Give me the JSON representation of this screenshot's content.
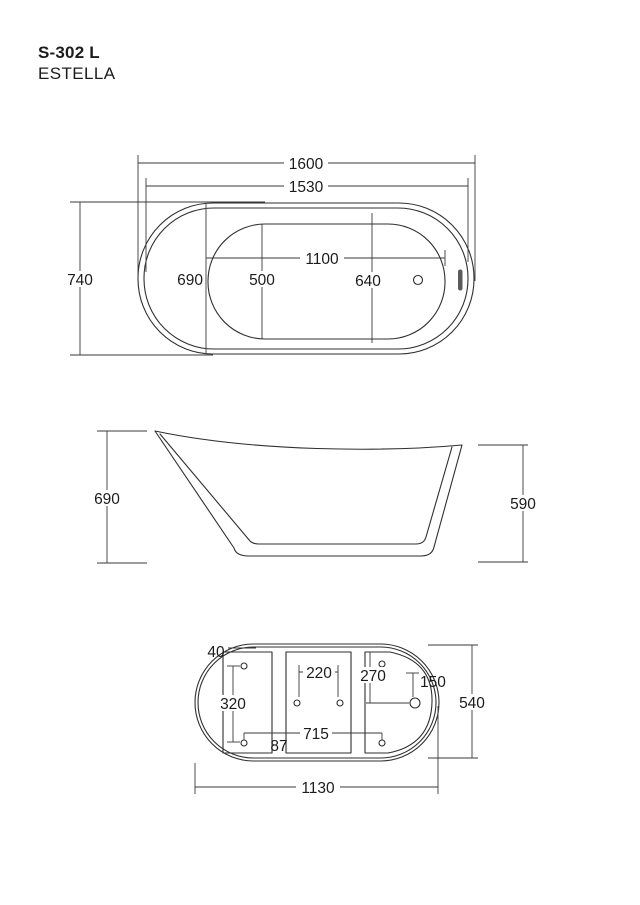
{
  "product": {
    "model": "S-302 L",
    "series": "ESTELLA"
  },
  "top_view": {
    "length_overall": "1600",
    "length_rim": "1530",
    "width_overall": "740",
    "width_rim": "690",
    "basin_length": "1100",
    "basin_width": "500",
    "width_at_drain": "640"
  },
  "side_view": {
    "height_back": "690",
    "height_front": "590"
  },
  "bottom_view": {
    "edge_offset": "40",
    "feet_span_across": "220",
    "drain_from_edge": "270",
    "drain_inset": "150",
    "feet_span_width": "320",
    "feet_span_length": "715",
    "panel_gap": "87",
    "base_width": "540",
    "base_length": "1130"
  },
  "colors": {
    "line": "#2f2f2f",
    "text": "#1c1c1c",
    "background": "#ffffff",
    "slot_fill": "#5a5a5a"
  }
}
